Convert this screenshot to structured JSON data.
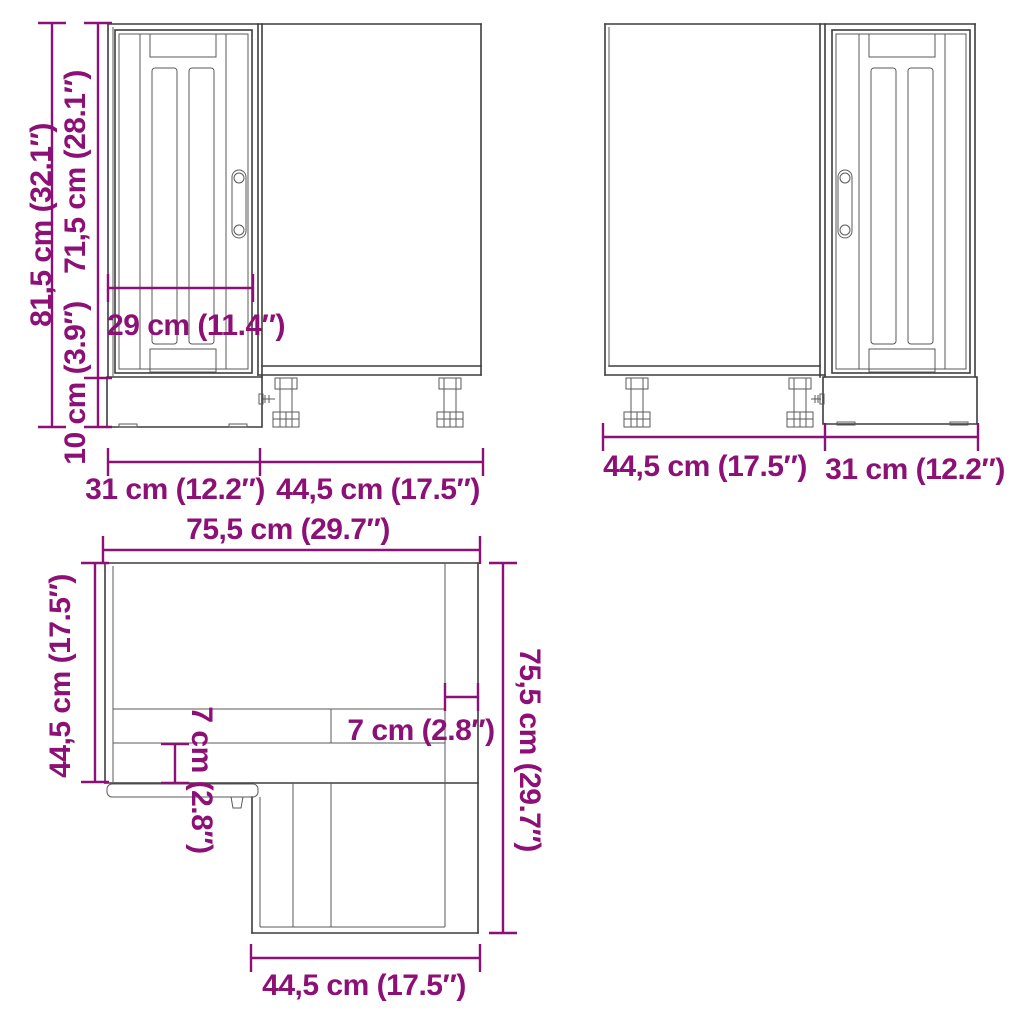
{
  "colors": {
    "dimension": "#8c1076",
    "line": "#3d3d3d",
    "background": "#ffffff"
  },
  "views": {
    "front_left": {
      "name": "front view door left",
      "dims": {
        "total_height": "81,5 cm (32.1″)",
        "door_height": "71,5 cm (28.1″)",
        "plinth_height": "10 cm (3.9″)",
        "door_width": "29 cm (11.4″)",
        "left_width": "31 cm (12.2″)",
        "right_width": "44,5 cm (17.5″)"
      }
    },
    "front_right": {
      "name": "front view door right",
      "dims": {
        "left_width": "44,5 cm (17.5″)",
        "right_width": "31 cm (12.2″)"
      }
    },
    "plan": {
      "name": "top view",
      "dims": {
        "top_width": "75,5 cm (29.7″)",
        "left_depth": "44,5 cm (17.5″)",
        "right_depth": "75,5 cm (29.7″)",
        "bottom_width": "44,5 cm (17.5″)",
        "panel_left": "7 cm (2.8″)",
        "panel_right": "7 cm (2.8″)"
      }
    }
  }
}
